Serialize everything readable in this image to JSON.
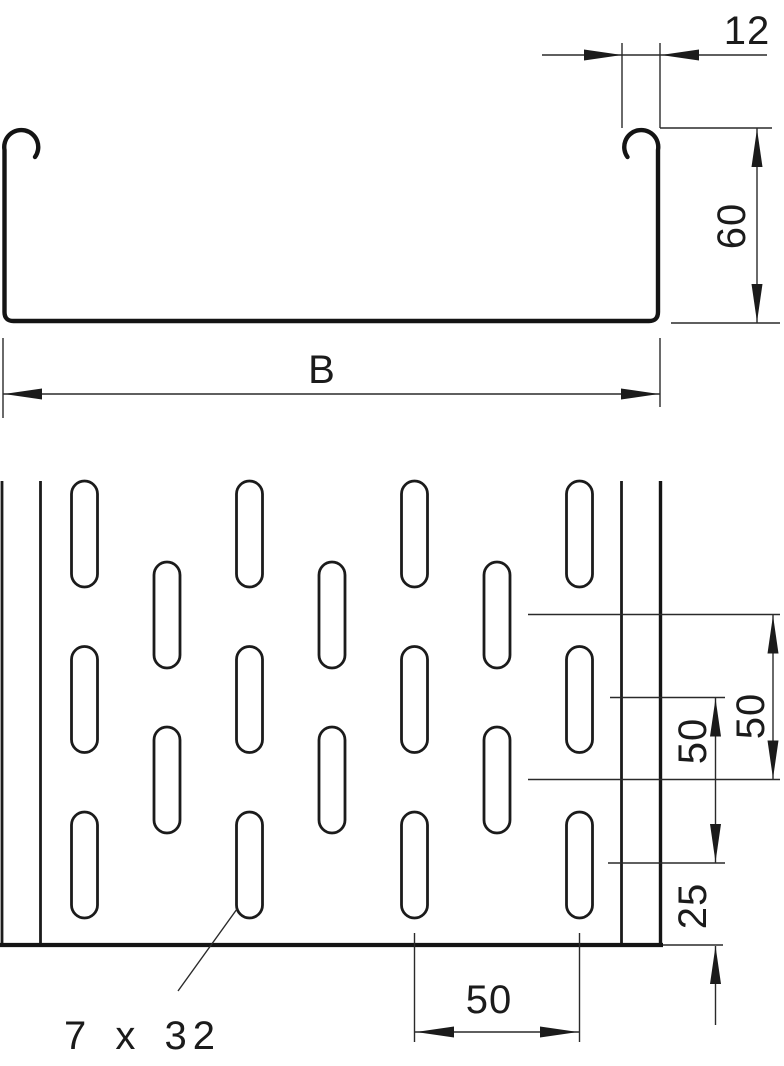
{
  "page": {
    "background": "#ffffff",
    "line_color": "#1b1b1b",
    "description": "Technical drawing of perforated cable tray: cross-section profile and perforation plan view"
  },
  "cross_section": {
    "dim_edge_width": {
      "label": "12"
    },
    "dim_height": {
      "label": "60"
    },
    "dim_width": {
      "label": "B"
    }
  },
  "plan": {
    "dim_row_pitch_outer": {
      "label": "50"
    },
    "dim_row_pitch_inner": {
      "label": "50"
    },
    "dim_row_edge": {
      "label": "25"
    },
    "dim_col_pitch": {
      "label": "50"
    },
    "slot_callout": {
      "label": "7 x 32"
    },
    "slots": {
      "width_px": 26,
      "length_px": 106,
      "columns_x": [
        84.5,
        167,
        249.5,
        332,
        414.5,
        497,
        579.5
      ],
      "even_column_row_tops_y": [
        481,
        646.5,
        812
      ],
      "odd_column_row_tops_y": [
        562,
        727
      ]
    }
  }
}
